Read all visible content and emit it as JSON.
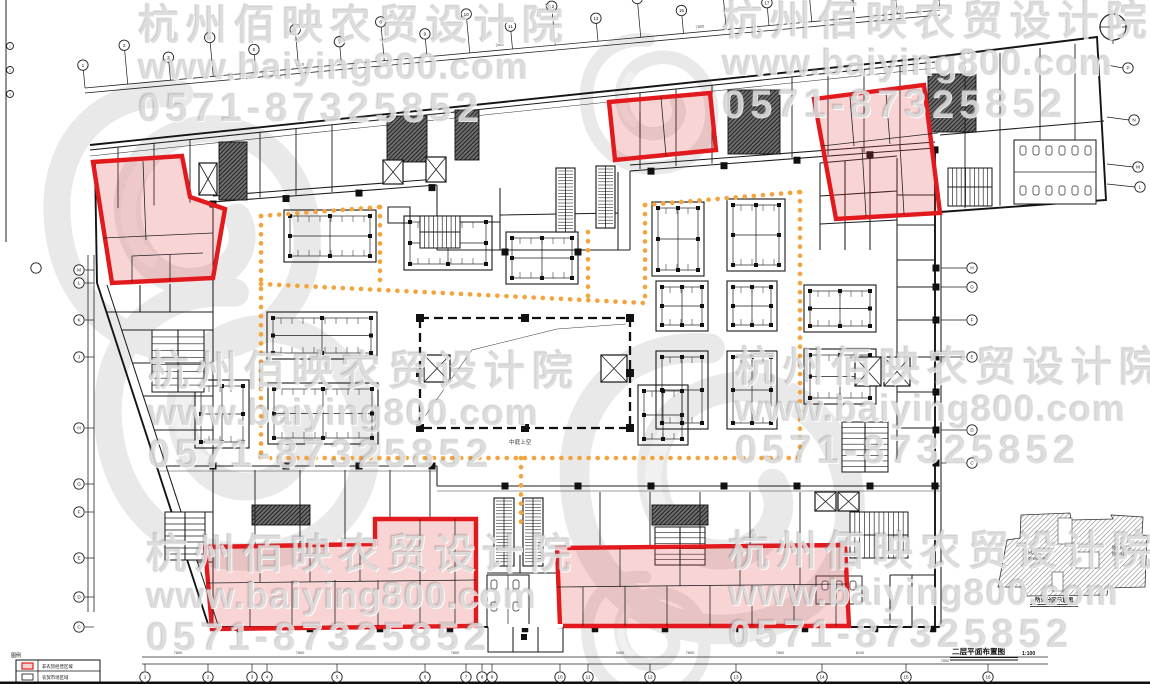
{
  "watermark": {
    "line1": "杭州佰映农贸设计院",
    "line2": "www.baiying800.com",
    "line3": "0571-87325852"
  },
  "title": {
    "name": "二层平面布置图",
    "scale": "1:100"
  },
  "keyplan": {
    "caption": "防火分区示意图",
    "zones": [
      {
        "name": "防火分区一",
        "area": "约2996.22㎡"
      },
      {
        "name": "防火分区二",
        "area": "约2552.74㎡"
      }
    ]
  },
  "legend": {
    "heading": "图例",
    "items": [
      {
        "label": "非农贸经营区域"
      },
      {
        "label": "农贸市场区域"
      }
    ]
  },
  "labels": {
    "atrium": "中庭上空"
  },
  "axes": {
    "top": [
      "1",
      "2",
      "3",
      "4",
      "5",
      "6",
      "7",
      "8",
      "9",
      "10",
      "11",
      "12",
      "13",
      "14",
      "15",
      "16",
      "17",
      "18",
      "19",
      "20",
      "21"
    ],
    "bottom": [
      "1",
      "2",
      "3",
      "4",
      "5",
      "6",
      "7",
      "8",
      "9",
      "10",
      "11",
      "12",
      "13",
      "14",
      "15",
      "16"
    ],
    "left": [
      "M",
      "L",
      "K",
      "J",
      "H",
      "G",
      "F",
      "E",
      "D",
      "C"
    ],
    "right": [
      "H",
      "G",
      "F",
      "E",
      "D",
      "C"
    ],
    "right_top": [
      "P",
      "N",
      "M",
      "L"
    ],
    "edge": [
      "1",
      "2",
      "3"
    ]
  },
  "dims": [
    "7800",
    "7800",
    "7800",
    "3400",
    "7800",
    "7800",
    "8100",
    "7800"
  ],
  "colors": {
    "zone_red": "#e2191d",
    "zone_fill": "rgba(229,57,63,0.22)",
    "path_orange": "#f3a43c",
    "ink": "#1b1b1b",
    "watermark": "#dcdcdc"
  }
}
